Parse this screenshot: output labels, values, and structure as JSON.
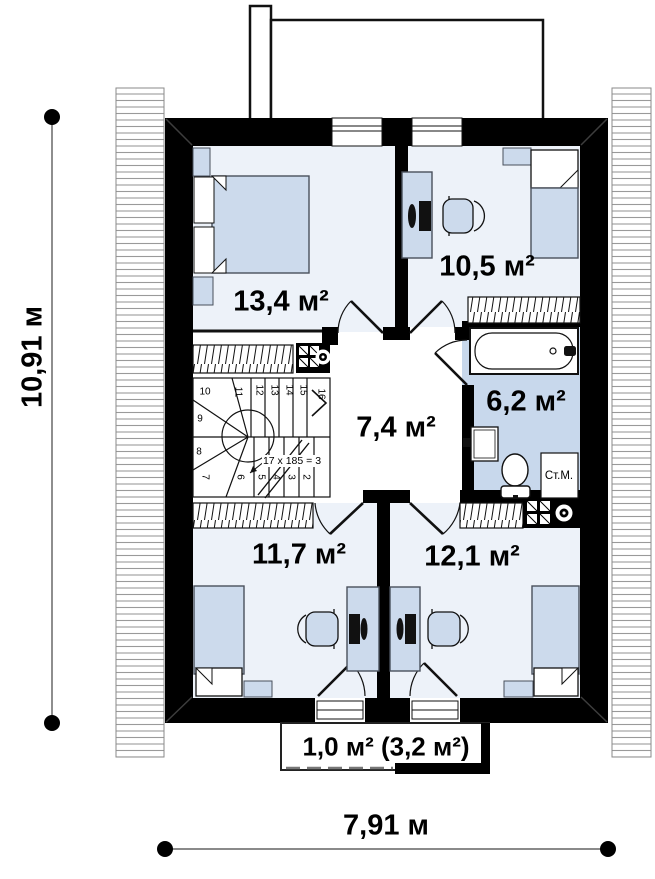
{
  "title": "Floor plan – second floor",
  "dimensions": {
    "left": "10,91 м",
    "bottom": "7,91 м"
  },
  "rooms": {
    "bedroom1": {
      "area": "13,4 м²"
    },
    "bedroom2": {
      "area": "10,5 м²"
    },
    "hall": {
      "area": "7,4 м²"
    },
    "bathroom": {
      "area": "6,2 м²"
    },
    "bedroom3": {
      "area": "11,7 м²"
    },
    "bedroom4": {
      "area": "12,1 м²"
    },
    "balcony": {
      "area": "1,0 м² (3,2 м²)"
    }
  },
  "stairs": {
    "note": "17 x 185 = 3",
    "numbers": [
      "2",
      "3",
      "4",
      "5",
      "6",
      "7",
      "8",
      "9",
      "10",
      "11",
      "12",
      "13",
      "14",
      "15",
      "16"
    ]
  },
  "appliances": {
    "washing_machine": "Ст.М."
  },
  "colors": {
    "wall": "#000000",
    "bedroom_floor": "#edf2f9",
    "bathroom_floor": "#c8d8ec",
    "furniture": "#ccdaec",
    "hatch_line": "#9a9a9a"
  }
}
